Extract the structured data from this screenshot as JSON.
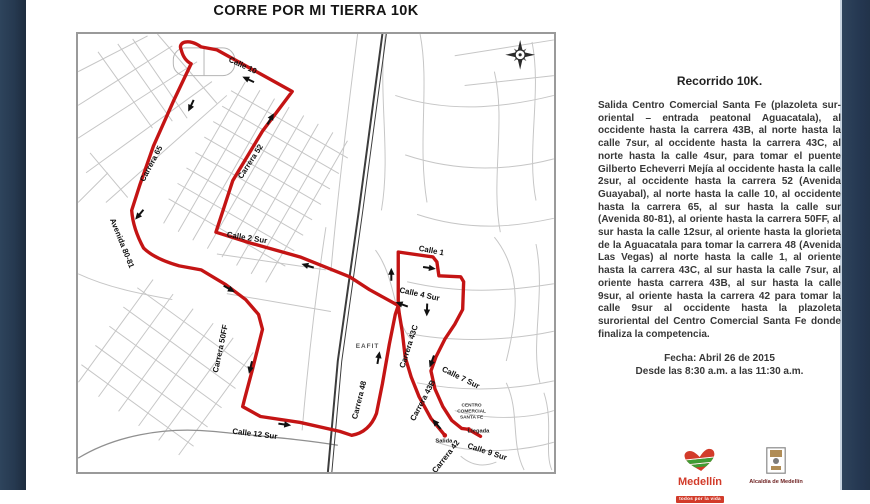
{
  "slide": {
    "title": "CORRE POR MI TIERRA 10K"
  },
  "map": {
    "labels": [
      {
        "text": "Calle 10"
      },
      {
        "text": "Carrera 52"
      },
      {
        "text": "Carrera 65"
      },
      {
        "text": "Avenida 80-81"
      },
      {
        "text": "Calle 2 Sur"
      },
      {
        "text": "Carrera 50FF"
      },
      {
        "text": "Calle 12 Sur"
      },
      {
        "text": "Carrera 48"
      },
      {
        "text": "Calle 1"
      },
      {
        "text": "Calle 4 Sur"
      },
      {
        "text": "Carrera 43C"
      },
      {
        "text": "Calle 7 Sur"
      },
      {
        "text": "Carrera 43B"
      },
      {
        "text": "Carrera 42"
      },
      {
        "text": "Calle 9 Sur"
      }
    ],
    "poi": {
      "eafit": "EAFIT",
      "mall_line1": "CENTRO",
      "mall_line2": "COMERCIAL",
      "mall_line3": "SANTA FE",
      "start": "Salida",
      "finish": "Llegada"
    }
  },
  "panel": {
    "heading": "Recorrido 10K.",
    "body": "Salida Centro Comercial Santa Fe (plazoleta sur-oriental – entrada peatonal Aguacatala), al occidente hasta la carrera 43B, al norte hasta la calle 7sur, al occidente hasta la carrera 43C, al norte hasta la calle 4sur, para tomar el puente Gilberto Echeverri Mejía al occidente hasta la calle 2sur, al occidente hasta la carrera 52 (Avenida Guayabal), al norte hasta la calle 10, al occidente hasta la carrera 65, al sur hasta la calle sur (Avenida 80-81), al oriente hasta la carrera 50FF, al sur hasta la calle 12sur, al oriente hasta la glorieta de la Aguacatala para tomar la carrera 48 (Avenida Las Vegas) al norte hasta la calle 1, al oriente hasta la carrera 43C, al sur hasta la calle 7sur, al oriente hasta carrera 43B, al sur hasta la calle 9sur, al oriente hasta la carrera 42 para tomar la calle 9sur al occidente hasta la plazoleta suroriental del Centro Comercial Santa Fe donde finaliza la competencia.",
    "date_line1": "Fecha:  Abril 26 de 2015",
    "date_line2": "Desde las 8:30 a.m. a las 11:30 a.m."
  },
  "footer": {
    "medellin_wordmark": "Medellín",
    "medellin_tagline": "todos por la vida",
    "alcaldia_label": "Alcaldía de Medellín"
  },
  "colors": {
    "route_red": "#c41414",
    "sidebar_navy": "#263950",
    "street_gray": "#c6c6c6",
    "railway_dark": "#3c3c3c",
    "accent_strip": "#c9d6e2",
    "logo_red": "#d23b2a",
    "logo_green": "#3f9c35"
  }
}
